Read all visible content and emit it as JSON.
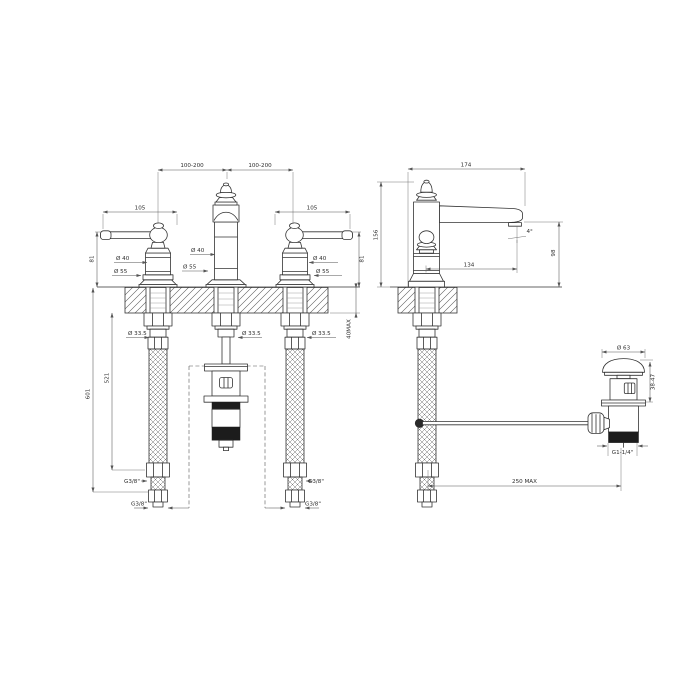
{
  "ink": "#333333",
  "drawing": {
    "front": {
      "spacing_left": "100-200",
      "spacing_right": "100-200",
      "handle_len_left": "105",
      "handle_len_right": "105",
      "height_left": "81",
      "height_right": "81",
      "dia40_left": "Ø 40",
      "dia40_center": "Ø 40",
      "dia40_right": "Ø 40",
      "dia55_left": "Ø 55",
      "dia55_center": "Ø 55",
      "dia55_right": "Ø 55",
      "dia335_left": "Ø 33.5",
      "dia335_center": "Ø 33.5",
      "dia335_right": "Ø 33.5",
      "deck_max": "40MAX",
      "hose_len": "521",
      "total_len": "601",
      "thread_left": "G3/8\"",
      "thread_right": "G3/8\"",
      "thread_bottom_left": "G3/8\"",
      "thread_bottom_right": "G3/8\""
    },
    "side": {
      "width": "174",
      "height": "156",
      "spout_reach": "134",
      "spout_height": "98",
      "spout_angle": "4°",
      "rod_max": "250 MAX"
    },
    "waste": {
      "dia": "Ø 63",
      "deck_range": "38-47",
      "thread": "G1-1/4\""
    }
  }
}
